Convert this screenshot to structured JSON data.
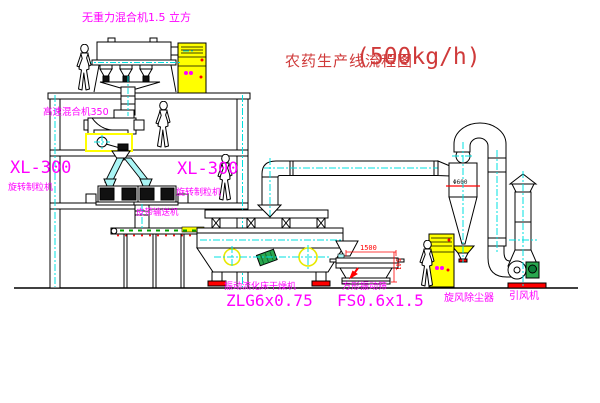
{
  "title": {
    "text": "农药生产线流程图",
    "capacity": "(500kg/h)"
  },
  "machines": {
    "gravity_mixer": {
      "label": "无重力混合机1.5 立方"
    },
    "high_speed_mixer": {
      "label": "高速混合机350"
    },
    "granulator_left": {
      "model": "XL-300",
      "name": "旋转制粒机"
    },
    "granulator_right": {
      "model": "XL-300",
      "name": "旋转制粒机"
    },
    "belt_conveyor": {
      "name": "皮带输送机"
    },
    "fluid_bed_dryer": {
      "name": "振动流化床干燥机",
      "model": "ZLG6x0.75"
    },
    "vibrating_screen": {
      "name": "方形振动筛",
      "model": "FS0.6x1.5",
      "dim_length": "1500",
      "dim_height": "541"
    },
    "cyclone": {
      "name": "旋风除尘器",
      "dim": "Φ600"
    },
    "induced_draft_fan": {
      "name": "引风机"
    }
  },
  "colors": {
    "label_magenta": "#ff00ff",
    "title_red": "#cf3a3a",
    "centerline_cyan": "#00e0e0",
    "highlight_yellow": "#ffff00",
    "accent_red": "#ff0000",
    "accent_green": "#2aa84f",
    "line_black": "#000000",
    "background": "#ffffff"
  }
}
